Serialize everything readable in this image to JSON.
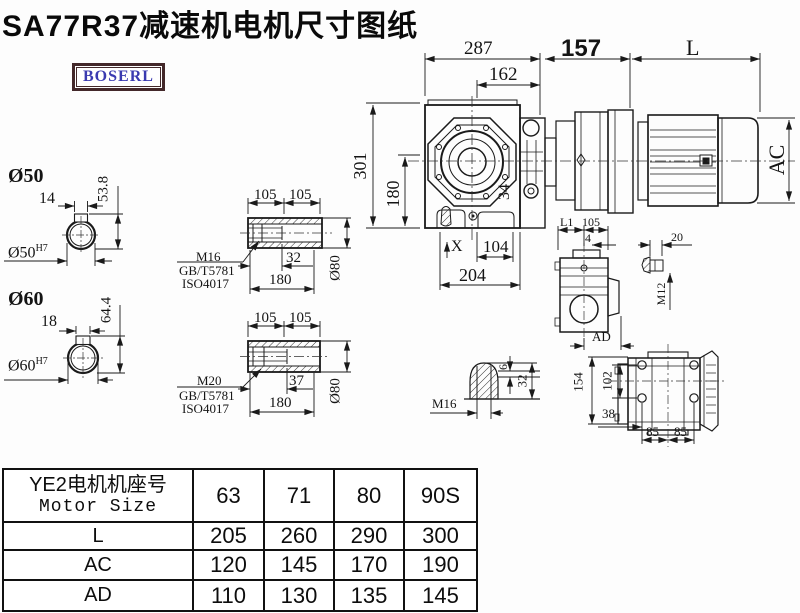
{
  "title": "SA77R37减速机电机尺寸图纸",
  "logo": {
    "text": "BOSERL"
  },
  "main_view": {
    "width_total": "287",
    "width_flange": "162",
    "adapter_len": "157",
    "motor_len": "L",
    "height_total": "301",
    "height_axis": "180",
    "dim_34": "34",
    "marker_x": "X",
    "foot_offset": "104",
    "foot_span": "204",
    "motor_dia": "AC"
  },
  "shaft_d50": {
    "label": "Ø50",
    "bore_label": "Ø50",
    "bore_tolerance": "H7",
    "key_width": "14",
    "key_height": "53.8"
  },
  "shaft_d60": {
    "label": "Ø60",
    "bore_label": "Ø60",
    "bore_tolerance": "H7",
    "key_width": "18",
    "key_height": "64.4"
  },
  "hollow_shaft_m16": {
    "half_len_a": "105",
    "half_len_b": "105",
    "bolt_depth": "32",
    "total_len": "180",
    "outer_dia": "Ø80",
    "thread": "M16",
    "standard_1": "GB/T5781",
    "standard_2": "ISO4017"
  },
  "hollow_shaft_m20": {
    "half_len_a": "105",
    "half_len_b": "105",
    "bolt_depth": "37",
    "total_len": "180",
    "outer_dia": "Ø80",
    "thread": "M20",
    "standard_1": "GB/T5781",
    "standard_2": "ISO4017"
  },
  "side_view": {
    "dim_l1": "L1",
    "dim_105": "105",
    "dim_4": "4",
    "dim_ad": "AD"
  },
  "bolt_detail": {
    "length": "20",
    "thread": "M12"
  },
  "plug_detail": {
    "thread": "M16",
    "tip_len": "6",
    "length": "32"
  },
  "rear_view": {
    "height_total": "154",
    "bolt_spacing_v": "102",
    "offset": "38",
    "bolt_pitch_a": "85",
    "bolt_pitch_b": "85"
  },
  "size_table": {
    "header_cn": "YE2电机机座号",
    "header_en": "Motor Size",
    "columns": [
      "63",
      "71",
      "80",
      "90S"
    ],
    "rows": [
      {
        "label": "L",
        "values": [
          "205",
          "260",
          "290",
          "300"
        ]
      },
      {
        "label": "AC",
        "values": [
          "120",
          "145",
          "170",
          "190"
        ]
      },
      {
        "label": "AD",
        "values": [
          "110",
          "130",
          "135",
          "145"
        ]
      }
    ]
  },
  "chart_data": {
    "type": "table",
    "title": "SA77R37减速机电机尺寸图纸",
    "columns": [
      "Motor Size",
      "63",
      "71",
      "80",
      "90S"
    ],
    "rows": [
      [
        "L",
        205,
        260,
        290,
        300
      ],
      [
        "AC",
        120,
        145,
        170,
        190
      ],
      [
        "AD",
        110,
        130,
        135,
        145
      ]
    ]
  }
}
